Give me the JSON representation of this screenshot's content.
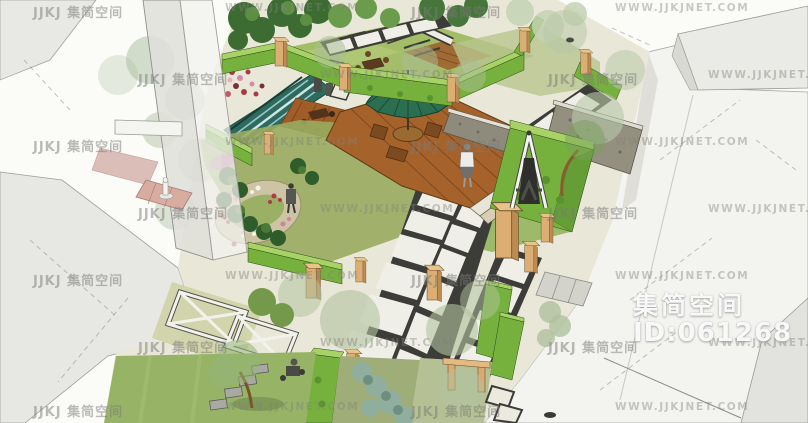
{
  "meta": {
    "type": "3d-landscape-courtyard-render",
    "width": 808,
    "height": 423
  },
  "watermark": {
    "badge_site_name": "集简空间",
    "badge_model_id": "ID:061268",
    "tile_logo": "JJKJ 集简空间",
    "tile_url": "WWW.JJKJNET.COM"
  },
  "palette": {
    "background": "#fbfbf8",
    "building_gray": "#e8e8e5",
    "ground_pale": "#f3f3ef",
    "lawn_green": "#9db96a",
    "hedge_green": "#76b13d",
    "hedge_top_green": "#a9d266",
    "wood_deck_brown": "#a5622b",
    "umbrella_green": "#2c6e50",
    "pool_teal": "#2e6b5c",
    "paver_white": "#f0efe7",
    "joint_dark": "#3c3c38",
    "pillar_tan": "#dcae74",
    "flower_pink": "#cf7fa6",
    "flower_red": "#ae3a4c",
    "stone_wall_gray": "#94907f",
    "watermark_gray": "#8f8f8c",
    "badge_white": "#ffffff"
  }
}
